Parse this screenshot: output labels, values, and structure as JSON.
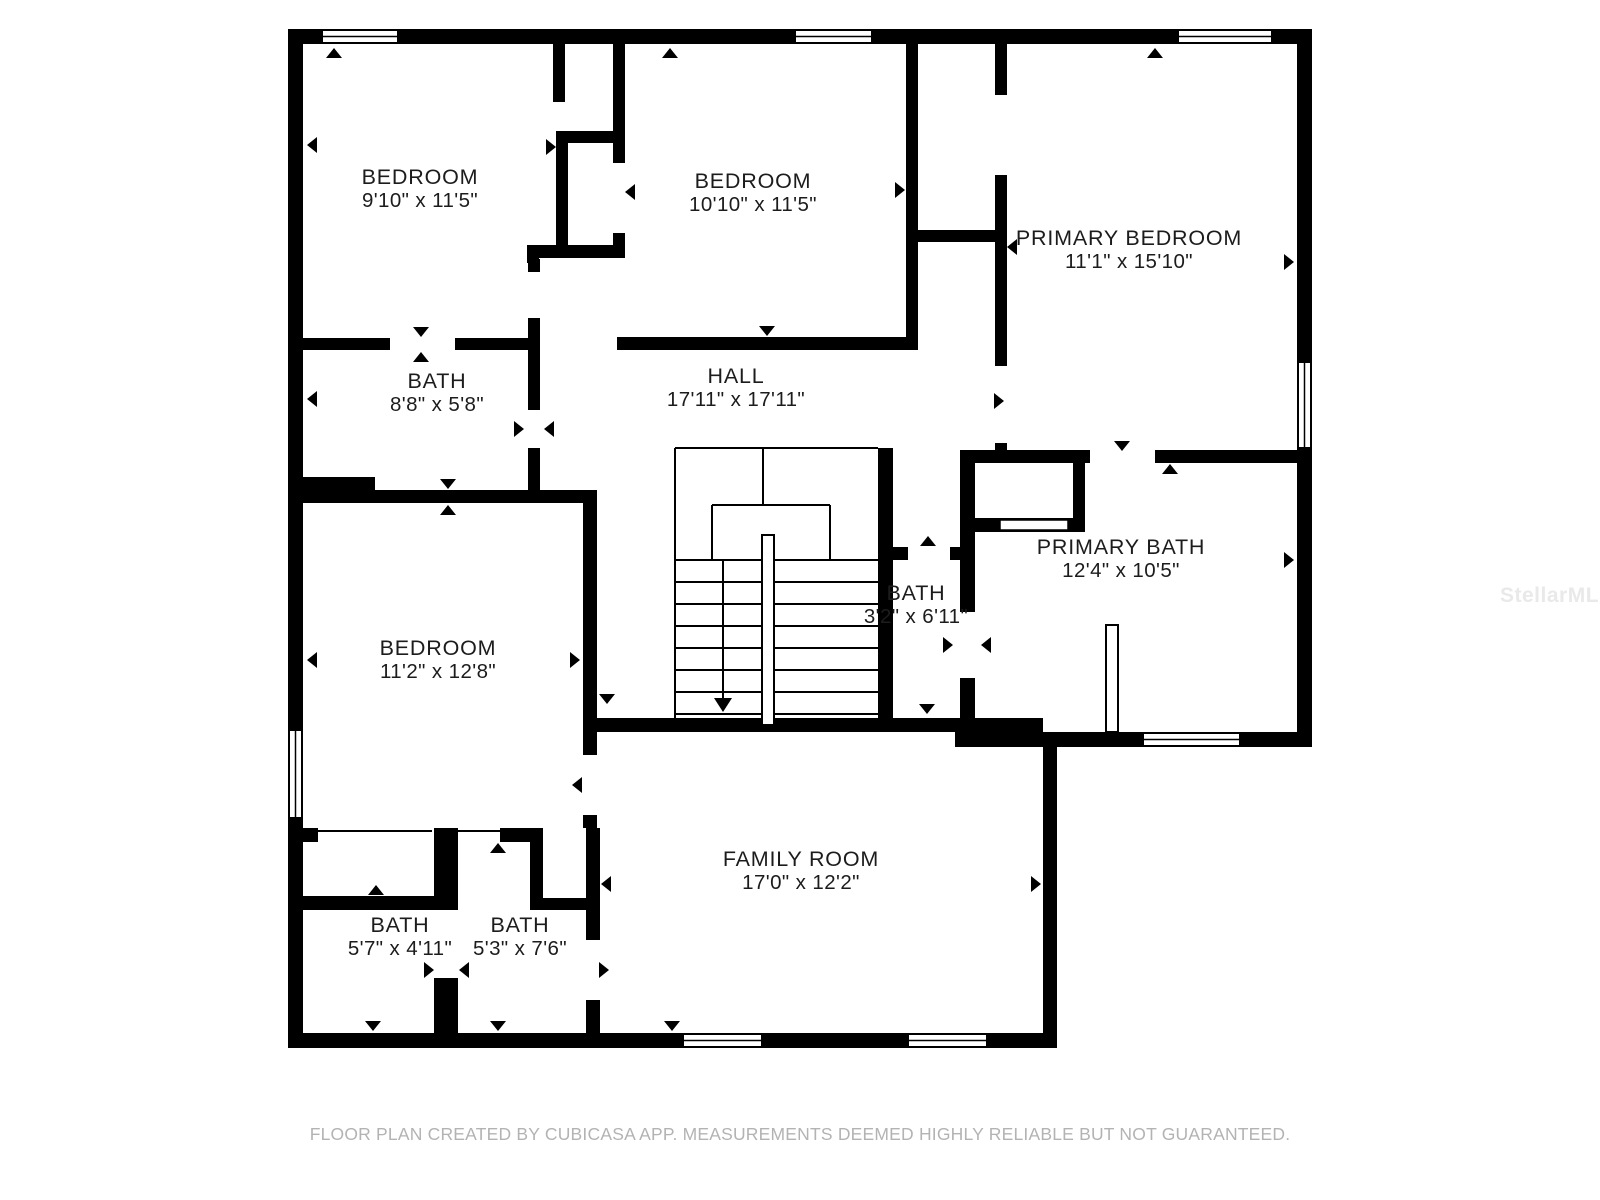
{
  "floor_plan": {
    "rooms": [
      {
        "id": "bedroom-top-left",
        "name": "BEDROOM",
        "dims": "9'10\" x 11'5\""
      },
      {
        "id": "bedroom-top-middle",
        "name": "BEDROOM",
        "dims": "10'10\" x 11'5\""
      },
      {
        "id": "primary-bedroom",
        "name": "PRIMARY BEDROOM",
        "dims": "11'1\" x 15'10\""
      },
      {
        "id": "bath-left",
        "name": "BATH",
        "dims": "8'8\" x 5'8\""
      },
      {
        "id": "hall",
        "name": "HALL",
        "dims": "17'11\" x 17'11\""
      },
      {
        "id": "primary-bath",
        "name": "PRIMARY BATH",
        "dims": "12'4\" x 10'5\""
      },
      {
        "id": "bath-middle",
        "name": "BATH",
        "dims": "3'2\" x 6'11\""
      },
      {
        "id": "bedroom-left",
        "name": "BEDROOM",
        "dims": "11'2\" x 12'8\""
      },
      {
        "id": "family-room",
        "name": "FAMILY ROOM",
        "dims": "17'0\" x 12'2\""
      },
      {
        "id": "bath-bottom-left",
        "name": "BATH",
        "dims": "5'7\" x 4'11\""
      },
      {
        "id": "bath-bottom-right",
        "name": "BATH",
        "dims": "5'3\" x 7'6\""
      }
    ],
    "footer": "FLOOR PLAN CREATED BY CUBICASA APP. MEASUREMENTS DEEMED HIGHLY RELIABLE BUT NOT GUARANTEED.",
    "watermark": "StellarMLS",
    "colors": {
      "wall": "#000000",
      "label": "#1c1c1c",
      "footer": "#b3b3b3",
      "watermark": "#e9e9e9",
      "background": "#ffffff"
    }
  }
}
